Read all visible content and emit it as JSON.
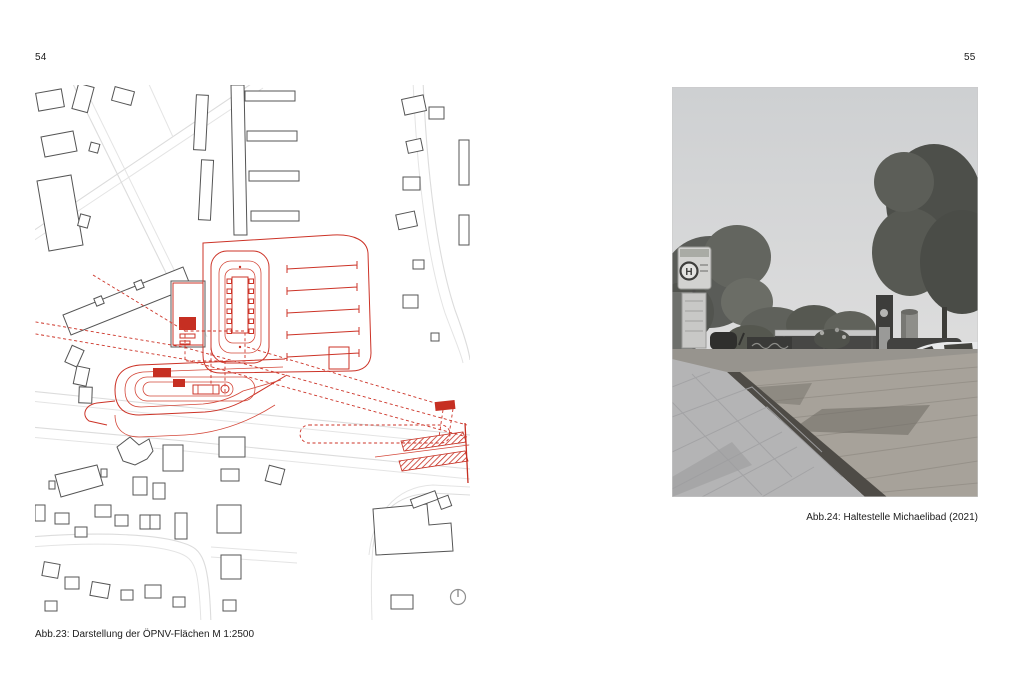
{
  "spread": {
    "background_color": "#ffffff",
    "left_page": {
      "page_number": "54",
      "figure_caption": "Abb.23: Darstellung der ÖPNV-Flächen M 1:2500",
      "map": {
        "type": "site-plan",
        "scale": "M 1:2500",
        "highlight_color": "#cc3327",
        "street_color": "#dcdcdc",
        "building_outline_color": "#555555",
        "north_arrow": "north-arrow-icon"
      }
    },
    "right_page": {
      "page_number": "55",
      "figure_caption": "Abb.24: Haltestelle Michaelibad (2021)",
      "photo": {
        "type": "black-and-white photograph",
        "bus_stop_sign_letter": "H"
      }
    }
  }
}
